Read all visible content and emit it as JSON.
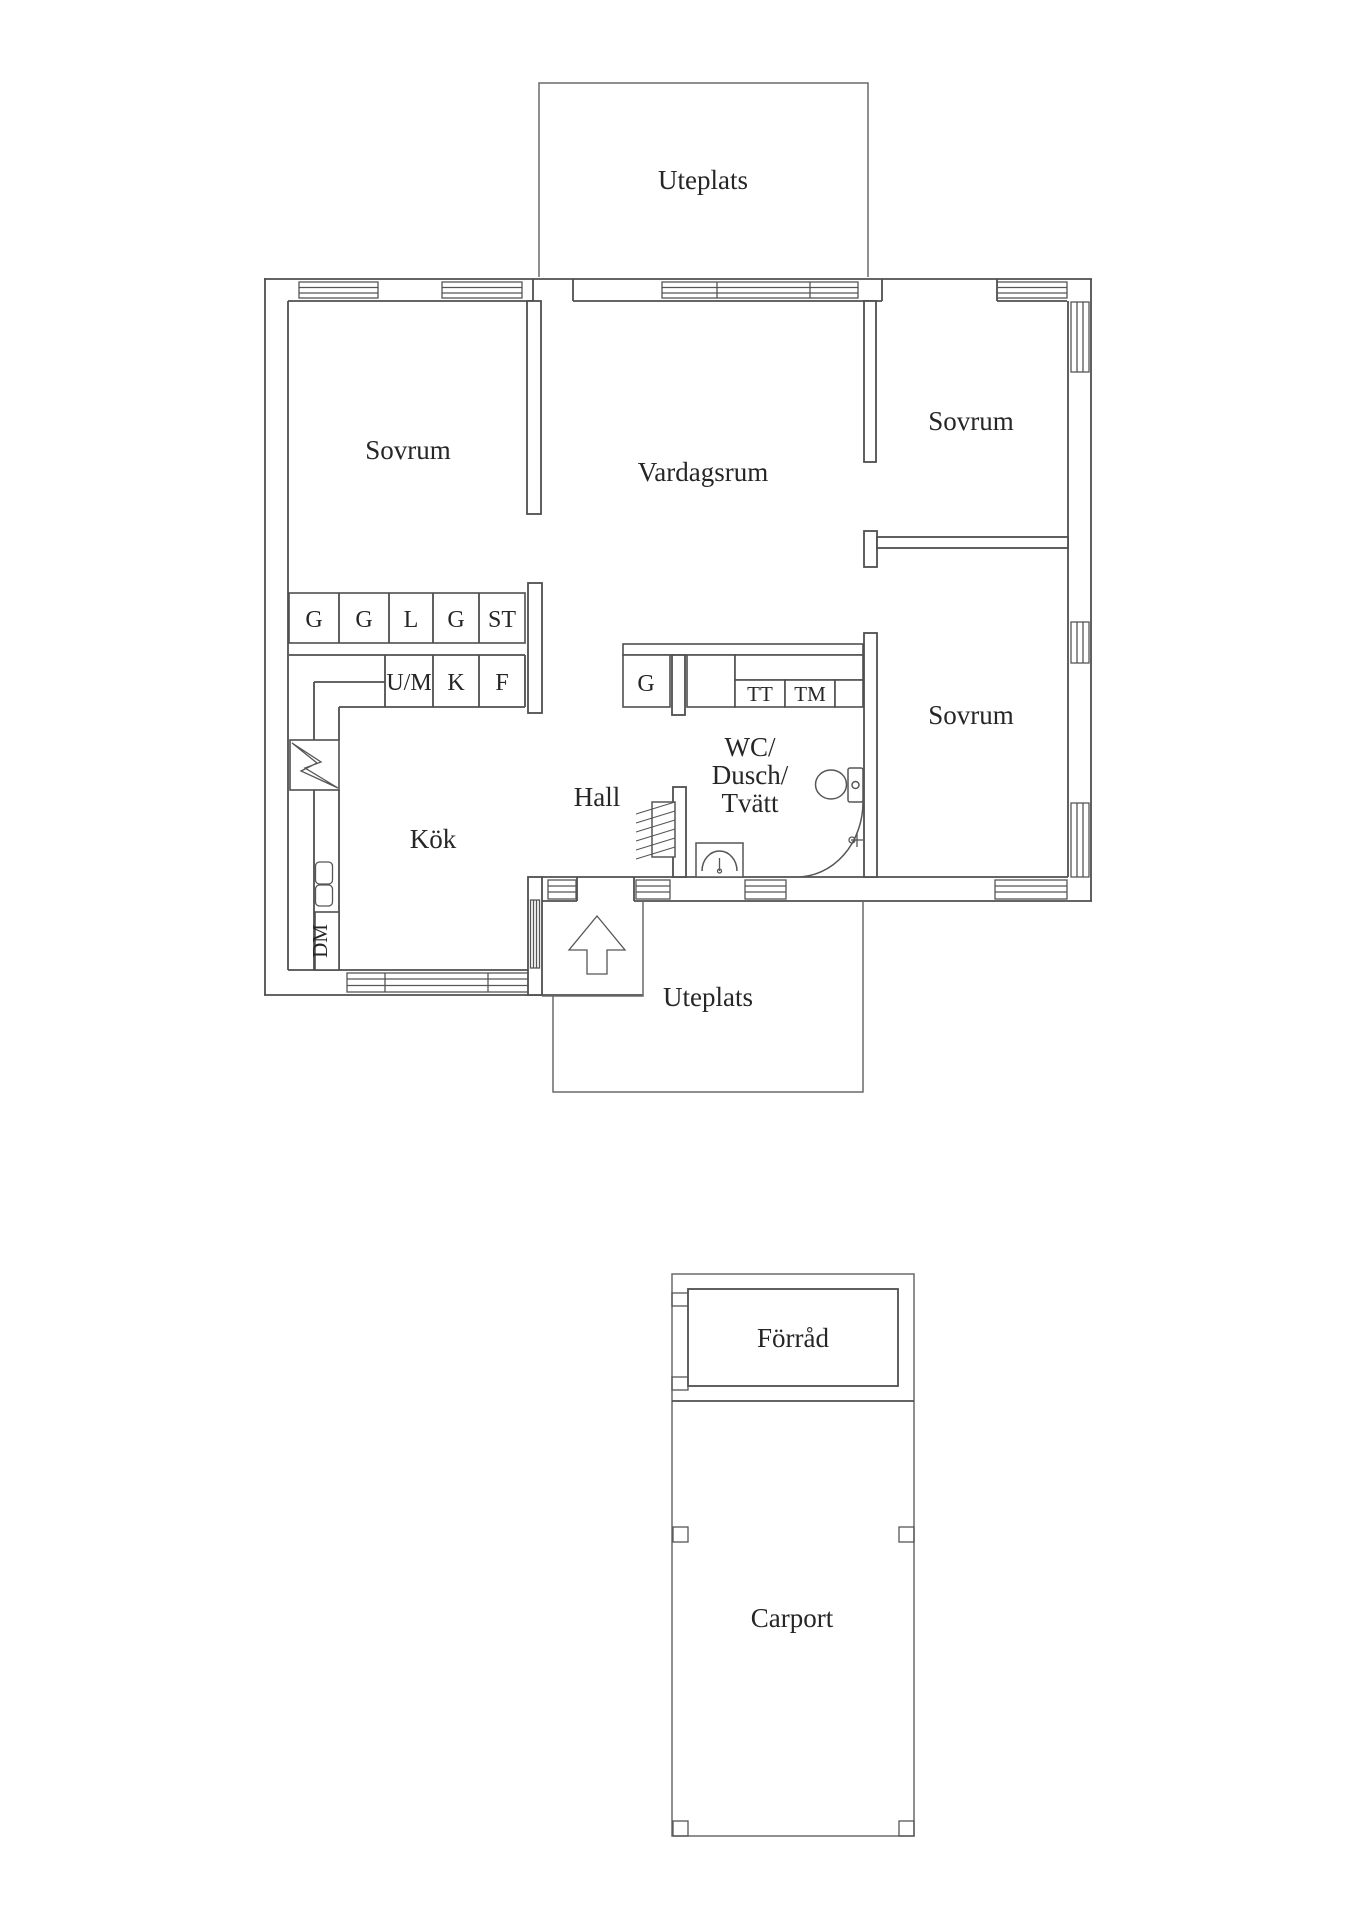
{
  "page": {
    "background": "#ffffff"
  },
  "colors": {
    "wall_line": "#4f4f4f",
    "fixture_line": "#565656",
    "text_color": "#262626"
  },
  "floorplan": {
    "rooms": [
      {
        "id": "bedroom-nw",
        "label": "Sovrum"
      },
      {
        "id": "living-room",
        "label": "Vardagsrum"
      },
      {
        "id": "bedroom-ne",
        "label": "Sovrum"
      },
      {
        "id": "bedroom-se",
        "label": "Sovrum"
      },
      {
        "id": "kitchen",
        "label": "Kök"
      },
      {
        "id": "hall",
        "label": "Hall"
      },
      {
        "id": "bathroom",
        "label": "WC/Dusch/Tvätt",
        "label_lines": [
          "WC/",
          "Dusch/",
          "Tvätt"
        ]
      }
    ],
    "terraces": [
      {
        "id": "terrace-north",
        "label": "Uteplats"
      },
      {
        "id": "terrace-south",
        "label": "Uteplats"
      }
    ],
    "outbuilding": {
      "storage_label": "Förråd",
      "carport_label": "Carport"
    },
    "wardrobes": [
      "G",
      "G",
      "L",
      "G",
      "ST"
    ],
    "kitchen_units": [
      "U/M",
      "K",
      "F"
    ],
    "kitchen_appliance": "DM",
    "laundry_units": [
      "G",
      "TT",
      "TM"
    ],
    "icons": {
      "stove": "stove-lightning-icon",
      "toilet": "toilet-icon",
      "sink": "sink-icon",
      "shower": "shower-arc-icon",
      "coat_rack": "coat-rack-icon",
      "faucet": "faucet-icon",
      "entrance": "entrance-arrow-icon",
      "window": "window-symbol"
    }
  }
}
